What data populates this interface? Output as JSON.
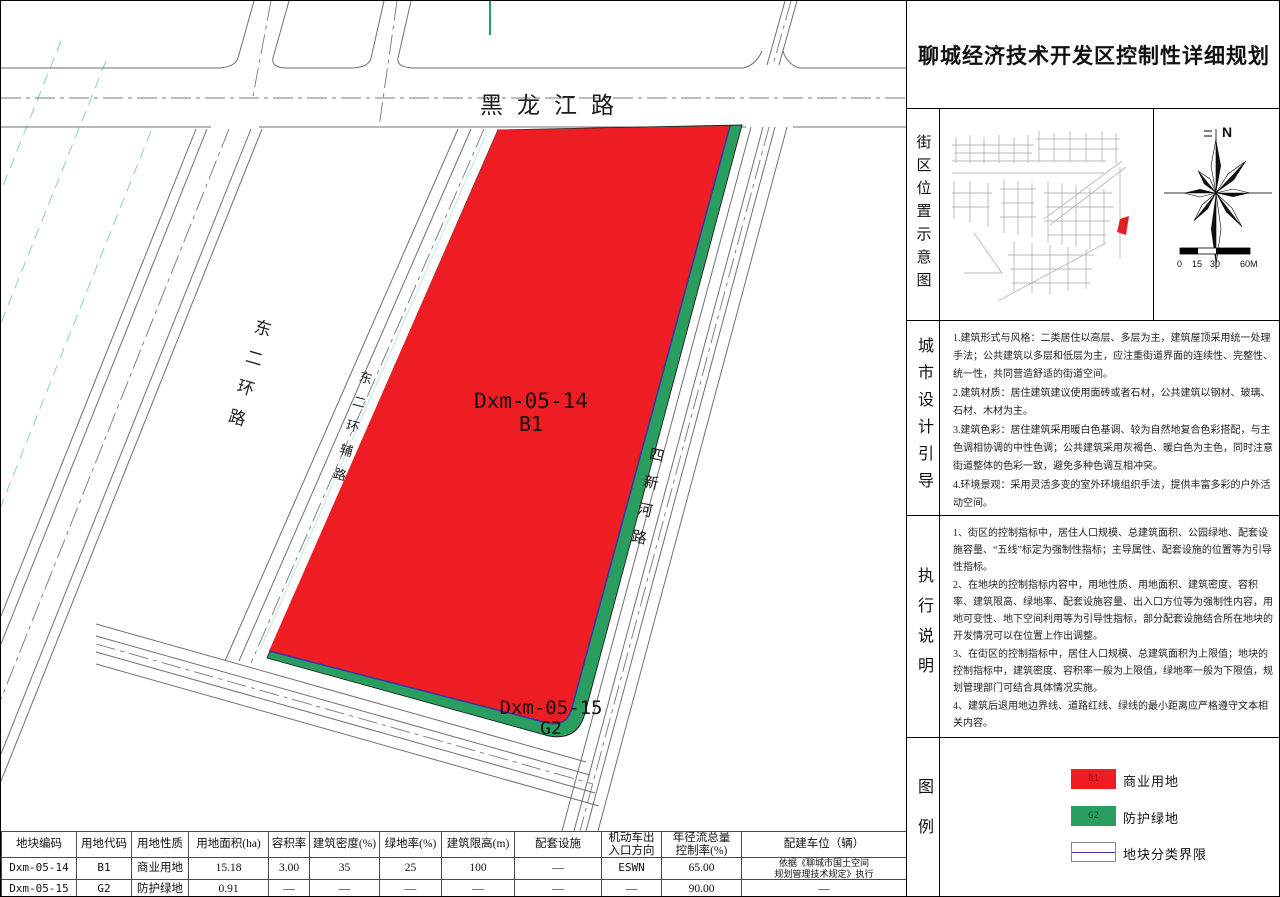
{
  "title": "聊城经济技术开发区控制性详细规划",
  "map": {
    "road_labels": {
      "heilongjiang": "黑龙江路",
      "dong_er_huan": "东二环路",
      "dong_er_huan_fu": "东二环辅路",
      "si_xin_he": "四新河路"
    },
    "parcels": {
      "commercial": {
        "code": "Dxm-05-14",
        "use_code": "B1"
      },
      "green": {
        "code": "Dxm-05-15",
        "use_code": "G2"
      }
    },
    "colors": {
      "commercial_fill": "#ee1d23",
      "green_fill": "#2a9e5f",
      "class_boundary": "#3a36aa"
    }
  },
  "location_section": {
    "label": "街区位置示意图",
    "north_label": "N",
    "scale_labels": [
      "0",
      "15",
      "30",
      "60M"
    ]
  },
  "design_guidance": {
    "label": "城市设计引导",
    "items": [
      "1.建筑形式与风格：二类居住以高层、多层为主，建筑屋顶采用统一处理手法；公共建筑以多层和低层为主，应注重街道界面的连续性、完整性、统一性，共同营造舒适的街道空间。",
      "2.建筑材质：居住建筑建议使用面砖或者石材，公共建筑以钢材、玻璃、石材、木材为主。",
      "3.建筑色彩：居住建筑采用暖白色基调、较为自然地复合色彩搭配，与主色调相协调的中性色调；公共建筑采用灰褐色、暖白色为主色，同时注意街道整体的色彩一致，避免多种色调互相冲突。",
      "4.环境景观：采用灵活多变的室外环境组织手法，提供丰富多彩的户外活动空间。"
    ]
  },
  "implementation_notes": {
    "label": "执行说明",
    "items": [
      "1、街区的控制指标中，居住人口规模、总建筑面积、公园绿地、配套设施容量、“五线”标定为强制性指标；主导属性、配套设施的位置等为引导性指标。",
      "2、在地块的控制指标内容中，用地性质、用地面积、建筑密度、容积率、建筑限高、绿地率、配套设施容量、出入口方位等为强制性内容，用地可变性、地下空间利用等为引导性指标，部分配套设施结合所在地块的开发情况可以在位置上作出调整。",
      "3、在街区的控制指标中，居住人口规模、总建筑面积为上限值；地块的控制指标中，建筑密度、容积率一般为上限值，绿地率一般为下限值，规划管理部门可结合具体情况实施。",
      "4、建筑后退用地边界线、道路红线、绿线的最小距离应严格遵守文本相关内容。"
    ]
  },
  "legend": {
    "label": "图例",
    "items": [
      {
        "code": "B1",
        "name": "商业用地"
      },
      {
        "code": "G2",
        "name": "防护绿地"
      },
      {
        "code": "",
        "name": "地块分类界限"
      }
    ]
  },
  "table": {
    "headers": [
      "地块编码",
      "用地代码",
      "用地性质",
      "用地面积(ha)",
      "容积率",
      "建筑密度(%)",
      "绿地率(%)",
      "建筑限高(m)",
      "配套设施",
      "机动车出\n入口方向",
      "年径流总量\n控制率(%)",
      "配建车位（辆）"
    ],
    "rows": [
      [
        "Dxm-05-14",
        "B1",
        "商业用地",
        "15.18",
        "3.00",
        "35",
        "25",
        "100",
        "—",
        "ESWN",
        "65.00",
        "依据《聊城市国土空间\n规划管理技术规定》执行"
      ],
      [
        "Dxm-05-15",
        "G2",
        "防护绿地",
        "0.91",
        "—",
        "—",
        "—",
        "—",
        "—",
        "—",
        "90.00",
        "—"
      ]
    ]
  }
}
